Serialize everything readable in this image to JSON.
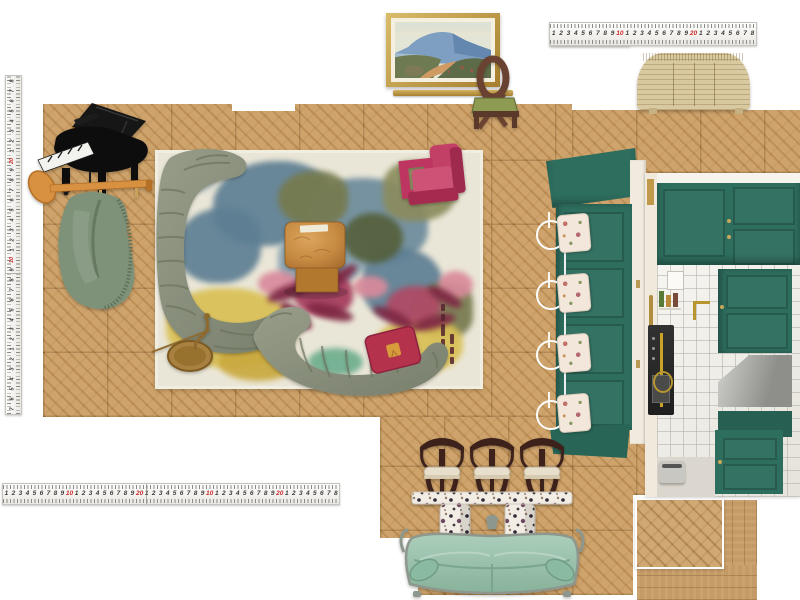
{
  "board": {
    "width": 800,
    "height": 600,
    "background": "#ffffff",
    "kind": "interior-design-moodboard-canvas"
  },
  "colors": {
    "floor": "#c89a5f",
    "floor_line": "#a97f47",
    "teal_cabinet": "#2e6e5f",
    "teal_dark": "#24594d",
    "rug_base": "#eae6d7",
    "rug_blue": "#5e7f93",
    "rug_olive": "#767a4e",
    "rug_yellow": "#d9c054",
    "rug_magenta": "#a53a5c",
    "rug_petal": "#7e2743",
    "sofa_green": "#8b917d",
    "sofa_channel": "#6c735e",
    "armchair_magenta": "#bb3a5e",
    "pillow_red": "#b5304e",
    "pillow_gold": "#d79b3a",
    "coffee_table_burl": "#c68a42",
    "brass": "#a8813f",
    "vintage_sofa_mint": "#9ec4ae",
    "vintage_sofa_frame": "#8e978d",
    "stool_wood": "#3c241d",
    "stool_seat": "#e7dfcb",
    "terrazzo_base": "#f1ece4",
    "sideboard_rattan": "#d9c9a0",
    "painting_frame_gold": "#c9a64f",
    "chair_walnut": "#6b4331",
    "chair_seat_green": "#8d9b52",
    "piano_black": "#0d0d0d",
    "coat_rack_orange": "#d8913f",
    "hanging_chair_green": "#7e9179",
    "steel_hood": "#9c9c99",
    "tile": "#edebe3",
    "ruler_red": "#cc2a2a",
    "ruler_ink": "#3c3b38"
  },
  "rulers": {
    "left": {
      "orientation": "vertical",
      "numbers": [
        "8",
        "7",
        "6",
        "5",
        "4",
        "3",
        "2",
        "1",
        "20",
        "9",
        "8",
        "7",
        "6",
        "5",
        "4",
        "3",
        "2",
        "1",
        "10",
        "9",
        "8",
        "7",
        "6",
        "5",
        "4",
        "3",
        "2",
        "1",
        "2",
        "3",
        "4",
        "5",
        "6",
        "7"
      ]
    },
    "top_right": {
      "orientation": "horizontal",
      "numbers": [
        "1",
        "2",
        "3",
        "4",
        "5",
        "6",
        "7",
        "8",
        "9",
        "10",
        "1",
        "2",
        "3",
        "4",
        "5",
        "6",
        "7",
        "8",
        "9",
        "20",
        "1",
        "2",
        "3",
        "4",
        "5",
        "6",
        "7",
        "8"
      ]
    },
    "bottom": {
      "orientation": "horizontal",
      "numbers": [
        "1",
        "2",
        "3",
        "4",
        "5",
        "6",
        "7",
        "8",
        "9",
        "10",
        "1",
        "2",
        "3",
        "4",
        "5",
        "6",
        "7",
        "8",
        "9",
        "20",
        "1",
        "2",
        "3",
        "4",
        "5",
        "6",
        "7",
        "8",
        "9",
        "10",
        "1",
        "2",
        "3",
        "4",
        "5",
        "6",
        "7",
        "8",
        "9",
        "20",
        "1",
        "2",
        "3",
        "4",
        "5",
        "6",
        "7",
        "8"
      ]
    }
  },
  "collage_items": [
    "measuring-tape-vertical",
    "measuring-tape-top",
    "measuring-tape-bottom",
    "parquet-floor-area",
    "chevron-floor-sample",
    "plank-floor-sample",
    "framed-landscape-painting",
    "picture-rail",
    "ribbon-back-chair",
    "rattan-sideboard",
    "grand-piano",
    "coat-rack-with-hanging-chair",
    "abstract-area-rug",
    "curved-sofa-left",
    "curved-sofa-bottom",
    "magenta-armchair",
    "burl-coffee-table",
    "brass-accent-table",
    "red-throw-pillow",
    "teal-breakfast-nook",
    "teal-kitchen-photo",
    "bar-stool",
    "bar-stool",
    "bar-stool",
    "terrazzo-console-table",
    "vintage-green-sofa"
  ]
}
